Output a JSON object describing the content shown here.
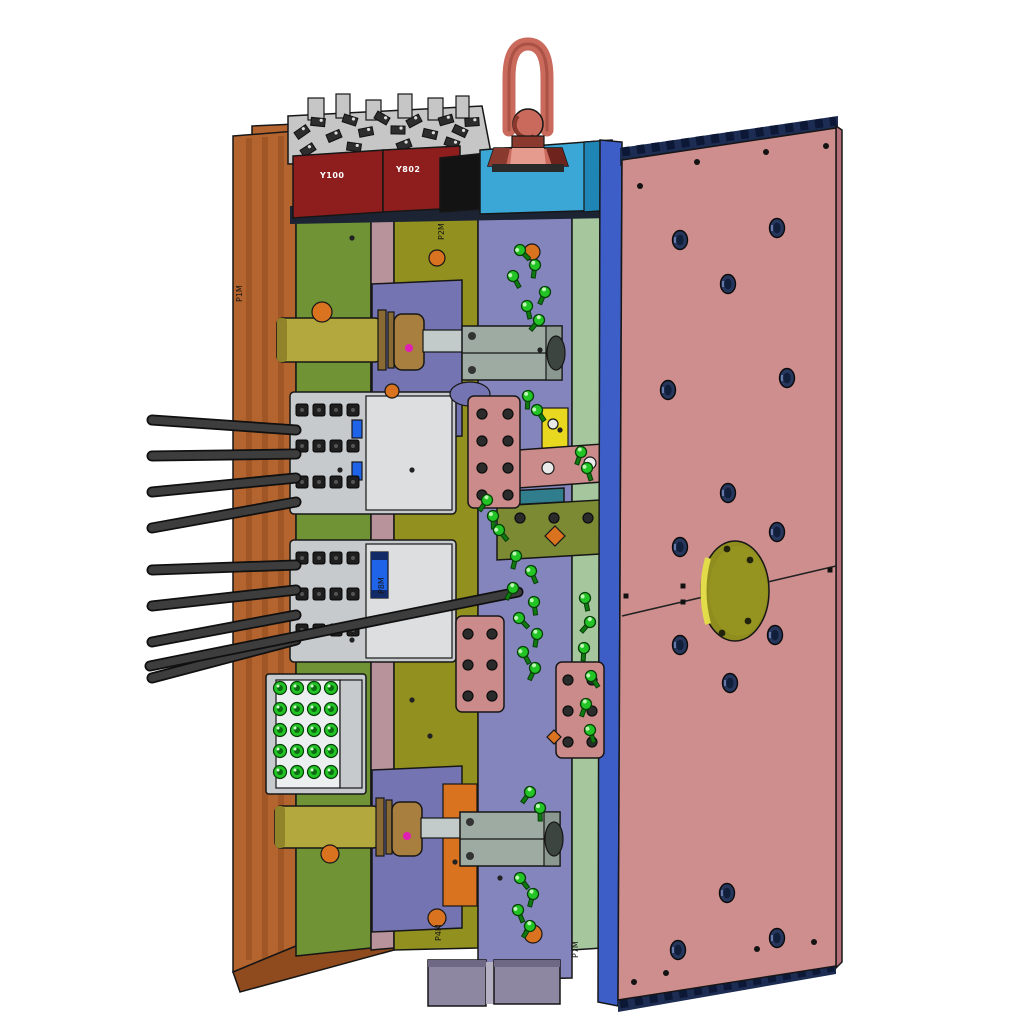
{
  "labels": {
    "junction_box_1": "Y100",
    "junction_box_2": "Y802",
    "mark_1": "P1M",
    "mark_2": "P2M",
    "mark_3": "P4M",
    "mark_4": "P7M",
    "mark_5": "P8M"
  },
  "colors": {
    "background": "#ffffff",
    "orange_plate": "#b4652f",
    "orange_dark": "#8f4a1e",
    "green_plate": "#6f9335",
    "mauve_strip": "#b9939c",
    "olive_plate": "#92901f",
    "purple_plate": "#8585bd",
    "purple_block": "#7574b2",
    "pale_green_strip": "#a6c79e",
    "blue_strip": "#3c5ec6",
    "pink_plate": "#cf8e8e",
    "pink_side": "#b5707a",
    "pink_band": "#1d2c52",
    "cyan_block": "#3aa7d6",
    "cyan_dark": "#1f85b5",
    "red_box": "#8e1d1d",
    "black_box": "#131313",
    "navy_shadow": "#1c2433",
    "metal_light": "#c6c6c6",
    "metal_mid": "#9a9a9a",
    "salmon_ring": "#c96a5c",
    "salmon_dark": "#8a392e",
    "salmon_deep": "#6e241c",
    "salmon_light": "#e59c8e",
    "yellow_cyl": "#b3a83e",
    "yellow_cyl_dark": "#8f842a",
    "tan_coupling": "#a97f40",
    "tan_dark": "#8a6a34",
    "rod_gray": "#c3cbca",
    "block_gray": "#9daba2",
    "block_gray_dark": "#8b988f",
    "end_ellipse": "#3c453f",
    "green_fitting": "#23c425",
    "green_fitting_dark": "#0f7a10",
    "pink_block": "#cc8b8b",
    "yellow_plate": "#e8d81f",
    "teal_bar": "#2f7d8d",
    "olive_block": "#7c8a33",
    "orange_accent": "#d9731f",
    "magenta": "#e01fb4",
    "hole_fill": "#26365c",
    "cable": "#3d3d3d",
    "connector_panel": "#c7cacd",
    "connector_panel_light": "#dcdee0",
    "connector_white": "#eceff0",
    "blue_connector": "#1f63e8",
    "foot_gray": "#8d87a1",
    "foot_light": "#b4b0c2",
    "locating_ring": "#8f8d1e",
    "locating_ring_mid": "#969420",
    "locating_ring_hi": "#e3dc4a"
  },
  "geometry": {
    "cables": [
      [
        296,
        430,
        152,
        420
      ],
      [
        296,
        454,
        152,
        456
      ],
      [
        296,
        478,
        152,
        492
      ],
      [
        296,
        502,
        152,
        528
      ],
      [
        296,
        565,
        152,
        570
      ],
      [
        296,
        590,
        152,
        606
      ],
      [
        296,
        615,
        152,
        642
      ],
      [
        296,
        640,
        152,
        678
      ],
      [
        518,
        592,
        150,
        666
      ]
    ],
    "fittings": [
      [
        520,
        250
      ],
      [
        535,
        265
      ],
      [
        513,
        276
      ],
      [
        545,
        292
      ],
      [
        527,
        306
      ],
      [
        539,
        320
      ],
      [
        528,
        396
      ],
      [
        537,
        410
      ],
      [
        581,
        452
      ],
      [
        587,
        468
      ],
      [
        487,
        500
      ],
      [
        493,
        516
      ],
      [
        499,
        530
      ],
      [
        516,
        556
      ],
      [
        531,
        571
      ],
      [
        513,
        588
      ],
      [
        534,
        602
      ],
      [
        519,
        618
      ],
      [
        537,
        634
      ],
      [
        523,
        652
      ],
      [
        535,
        668
      ],
      [
        585,
        598
      ],
      [
        590,
        622
      ],
      [
        584,
        648
      ],
      [
        591,
        676
      ],
      [
        586,
        704
      ],
      [
        590,
        730
      ],
      [
        530,
        792
      ],
      [
        540,
        808
      ],
      [
        520,
        878
      ],
      [
        533,
        894
      ],
      [
        518,
        910
      ],
      [
        530,
        926
      ]
    ],
    "coupler_grid": {
      "cols": [
        280,
        297,
        314,
        331
      ],
      "rows": [
        688,
        709,
        730,
        751,
        772
      ]
    },
    "plate_holes": [
      [
        680,
        240
      ],
      [
        777,
        228
      ],
      [
        728,
        284
      ],
      [
        668,
        390
      ],
      [
        787,
        378
      ],
      [
        728,
        493
      ],
      [
        680,
        547
      ],
      [
        777,
        532
      ],
      [
        680,
        645
      ],
      [
        775,
        635
      ],
      [
        730,
        683
      ],
      [
        727,
        893
      ],
      [
        678,
        950
      ],
      [
        777,
        938
      ]
    ],
    "corner_dots": [
      [
        640,
        186
      ],
      [
        697,
        162
      ],
      [
        766,
        152
      ],
      [
        826,
        146
      ],
      [
        634,
        982
      ],
      [
        666,
        973
      ],
      [
        757,
        949
      ],
      [
        814,
        942
      ]
    ],
    "parting_ticks": [
      [
        683,
        586
      ],
      [
        683,
        602
      ],
      [
        762,
        576
      ],
      [
        762,
        590
      ],
      [
        626,
        596
      ],
      [
        830,
        570
      ]
    ],
    "plate_dots": [
      [
        352,
        238
      ],
      [
        340,
        470
      ],
      [
        352,
        640
      ],
      [
        430,
        736
      ],
      [
        455,
        862
      ],
      [
        540,
        350
      ],
      [
        500,
        878
      ],
      [
        560,
        430
      ],
      [
        412,
        470
      ],
      [
        412,
        700
      ]
    ],
    "ring_screws": [
      [
        727,
        549
      ],
      [
        750,
        560
      ],
      [
        722,
        633
      ],
      [
        748,
        621
      ]
    ],
    "screw_blocks": [
      {
        "x": 482,
        "y": 414,
        "cols": 2,
        "rows": 4,
        "dx": 26,
        "dy": 27,
        "r": 5
      },
      {
        "x": 468,
        "y": 634,
        "cols": 2,
        "rows": 3,
        "dx": 24,
        "dy": 31,
        "r": 5
      },
      {
        "x": 568,
        "y": 680,
        "cols": 2,
        "rows": 3,
        "dx": 24,
        "dy": 31,
        "r": 5
      },
      {
        "x": 520,
        "y": 518,
        "cols": 3,
        "rows": 1,
        "dx": 34,
        "dy": 0,
        "r": 5
      }
    ],
    "pins": [
      {
        "x": 302,
        "y": 410,
        "cols": 4,
        "rows": 3,
        "dx": 17,
        "dy": 36
      },
      {
        "x": 302,
        "y": 558,
        "cols": 4,
        "rows": 3,
        "dx": 17,
        "dy": 36
      }
    ],
    "speckles": [
      [
        302,
        132
      ],
      [
        318,
        122
      ],
      [
        334,
        136
      ],
      [
        350,
        120
      ],
      [
        366,
        132
      ],
      [
        382,
        118
      ],
      [
        398,
        130
      ],
      [
        414,
        121
      ],
      [
        430,
        134
      ],
      [
        446,
        120
      ],
      [
        460,
        131
      ],
      [
        472,
        122
      ],
      [
        308,
        150
      ],
      [
        354,
        147
      ],
      [
        404,
        145
      ],
      [
        452,
        143
      ]
    ]
  }
}
